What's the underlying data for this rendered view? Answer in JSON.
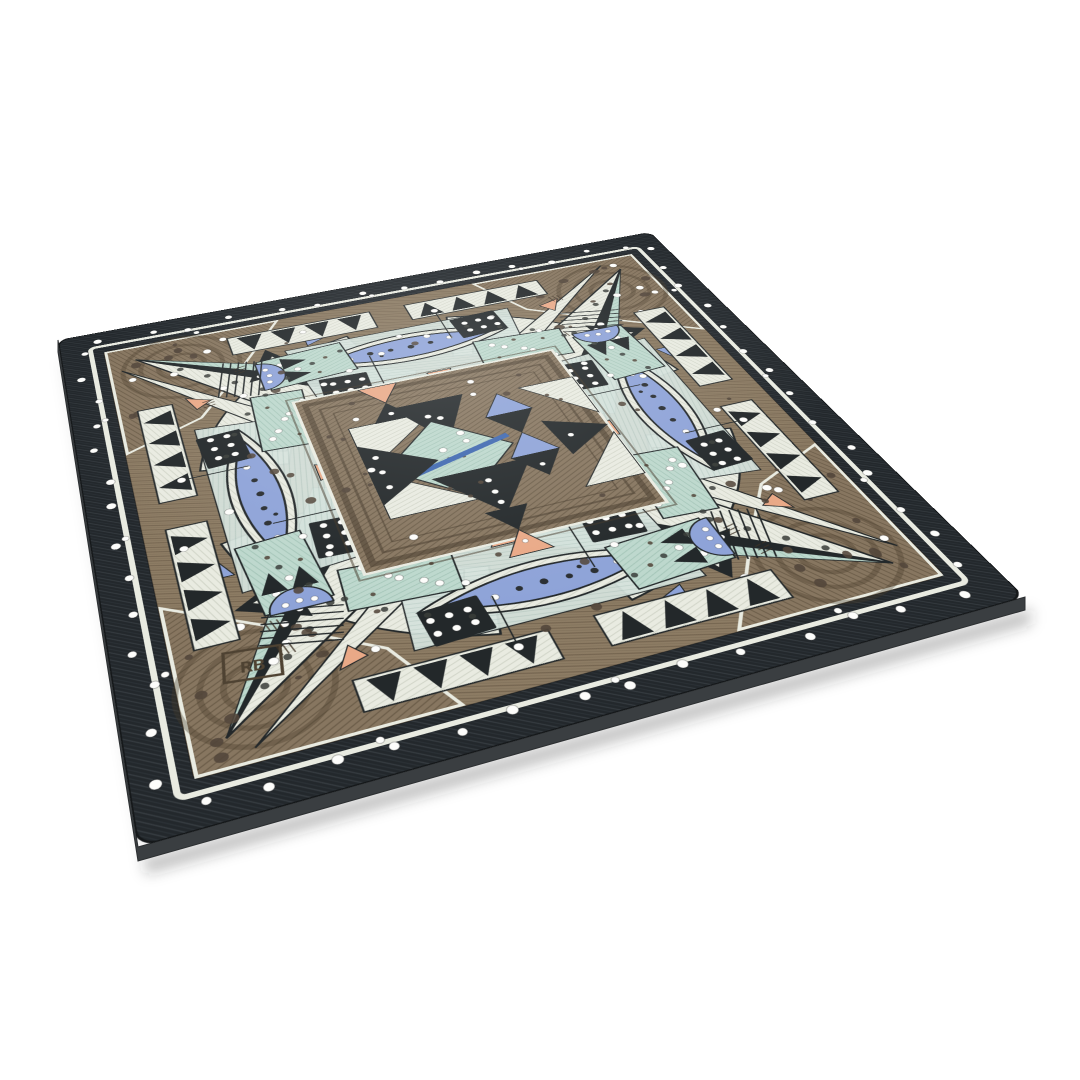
{
  "scene": {
    "type": "product photograph",
    "subject": "square ceramic art plate with carved sgraffito geometric mandala pattern",
    "style": "four-fold symmetric design: dotted black border, engraved taupe clay panels, cream star rays and crescent ring, mint and aqua panels, periwinkle lens shapes, black domino squares with white dots, salmon triangle accents, central triangle quilt medallion",
    "background": "seamless white",
    "view": "three-quarter perspective, plate tilted with visible edge thickness"
  },
  "signature": {
    "text": "RB"
  },
  "palette": {
    "page-bg": "#ffffff",
    "border-black": "#23282c",
    "border-line": "#363c41",
    "clay-brown": "#8d7c64",
    "clay-brown-dark": "#6e5f4b",
    "panel-brown": "#877660",
    "panel-brown-dark": "#665844",
    "hole-brown": "#52453a",
    "cream": "#e9ebe1",
    "cream-line": "#cdd1c4",
    "mint": "#bdd8cd",
    "mint-line": "#a0c2b5",
    "aqua": "#d5e2dc",
    "aqua-line": "#bccfc8",
    "periwinkle": "#8ea3d8",
    "accent-blue": "#3f68b0",
    "salmon": "#e9a987",
    "ink": "#23282a",
    "dot-white": "#fdfdfb",
    "side-gray": "#3a3e41"
  },
  "decor": {
    "border_dots_per_edge": 13,
    "corner_panel_holes": 12,
    "corner_panel_white_dots": 6,
    "interior_holes": 26,
    "interior_white_dots": 16,
    "center_holes": 12,
    "center_white_dots": 8,
    "crescent_dark_dots": 7,
    "crescent_white_dots": 5,
    "domino_dot_rows": 2,
    "domino_dot_cols": 3,
    "sawtooth_teeth_per_strip": 4
  }
}
